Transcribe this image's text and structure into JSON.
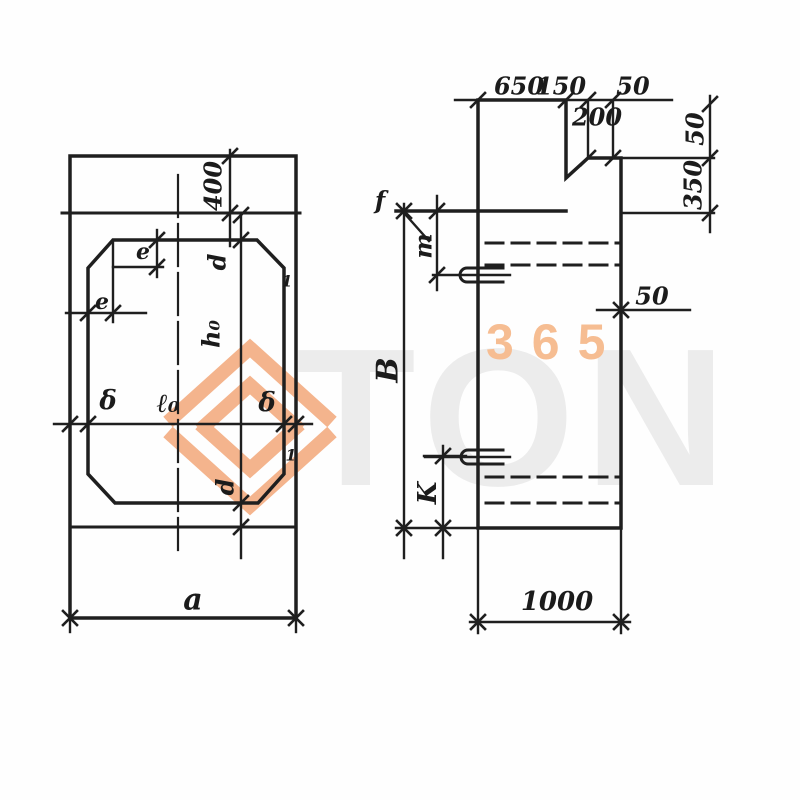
{
  "watermark": {
    "number": "365",
    "word": "TON",
    "orange": "#f3a87a",
    "peach": "#f6bd92",
    "gray": "#ececec"
  },
  "left_view": {
    "dim_400": "400",
    "dim_e_vertical": "e",
    "dim_e_horizontal": "e",
    "dim_d_top": "d",
    "dim_h0": "h₀",
    "dim_delta_left": "δ",
    "dim_l0": "ℓ₀",
    "dim_delta_right": "δ",
    "dim_d_bottom": "d",
    "dim_a": "a",
    "section_mark_top": "1",
    "section_mark_bottom": "1"
  },
  "right_view": {
    "dim_650": "650",
    "dim_150": "150",
    "dim_50_top": "50",
    "dim_200": "200",
    "dim_50_right": "50",
    "dim_350": "350",
    "label_f": "f",
    "label_m": "m",
    "label_B": "B",
    "label_K": "K",
    "dim_50_mid": "50",
    "dim_1000": "1000"
  }
}
